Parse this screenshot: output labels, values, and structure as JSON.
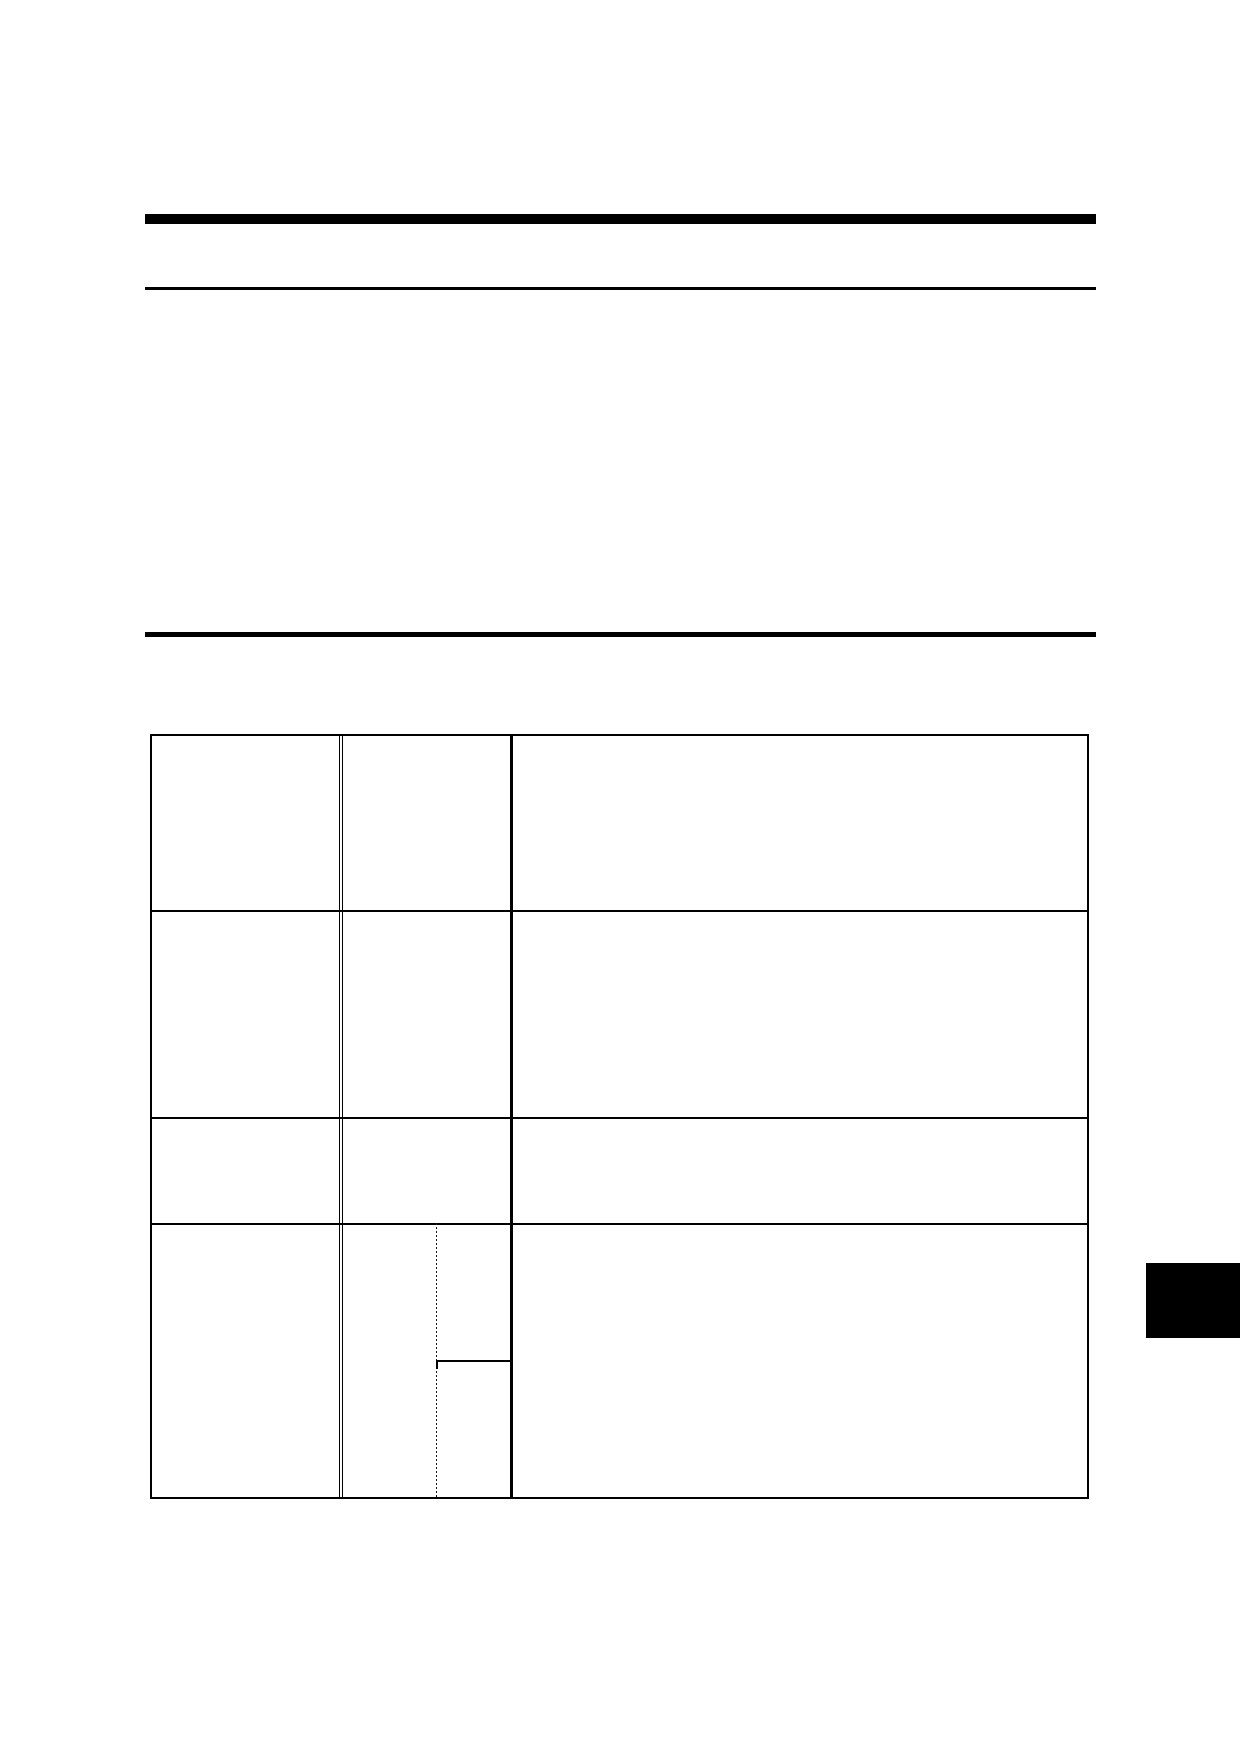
{
  "page": {
    "background_color": "#ffffff",
    "ink_color": "#000000",
    "header": {
      "title_text": "",
      "subtitle_text": ""
    },
    "section": {
      "heading_text": ""
    }
  },
  "table": {
    "rows": [
      {
        "cells": [
          "",
          "",
          ""
        ]
      },
      {
        "cells": [
          "",
          "",
          ""
        ]
      },
      {
        "cells": [
          "",
          "",
          ""
        ]
      },
      {
        "cells": [
          "",
          "",
          "",
          ""
        ]
      }
    ]
  },
  "edge_tab": {
    "color": "#000000",
    "label": ""
  }
}
